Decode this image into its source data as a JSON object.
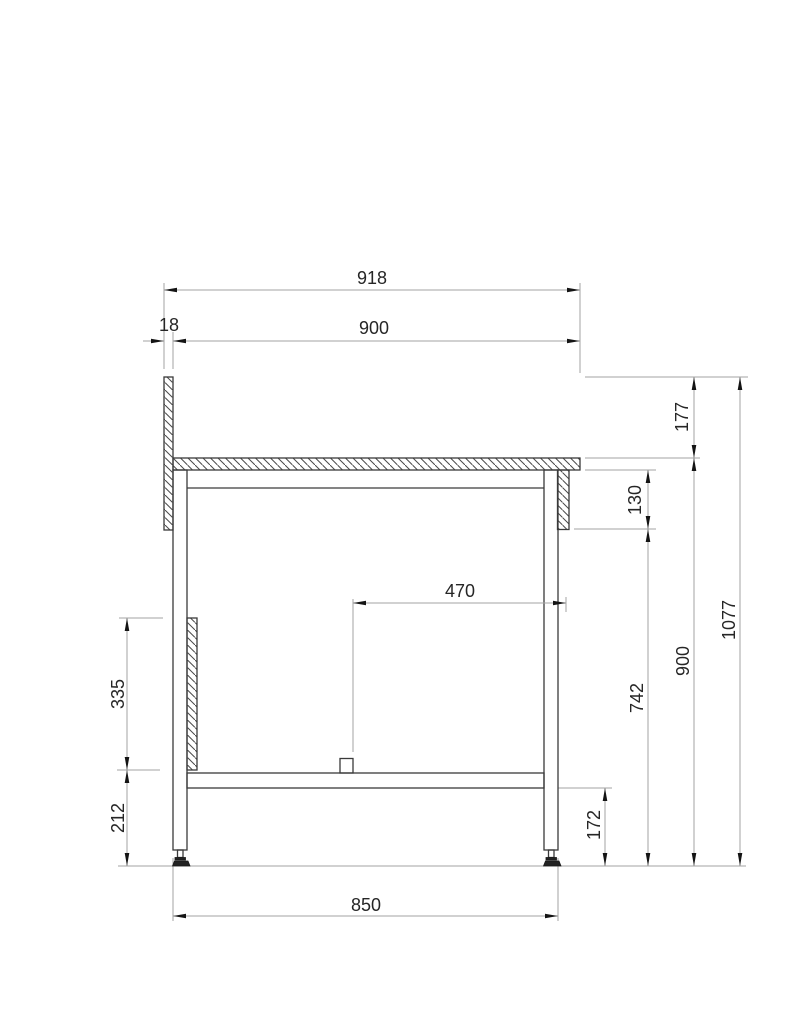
{
  "drawing": {
    "title": "workbench-side-elevation",
    "dims": {
      "overall_depth": "918",
      "upstand_thickness": "18",
      "worktop_depth": "900",
      "upstand_above_top": "177",
      "apron_height": "130",
      "block_to_rail": "470",
      "overall_height": "1077",
      "worktop_height": "900",
      "under_top_clearance": "742",
      "side_panel_height": "335",
      "panel_to_floor": "212",
      "shelf_to_floor": "172",
      "foot_spacing": "850"
    },
    "colors": {
      "outline": "#3a3a3a",
      "hatch": "#4a4a4a",
      "dimension_lines": "#a3a3a3",
      "arrowheads": "#141414",
      "text": "#262626",
      "background": "#ffffff"
    }
  }
}
